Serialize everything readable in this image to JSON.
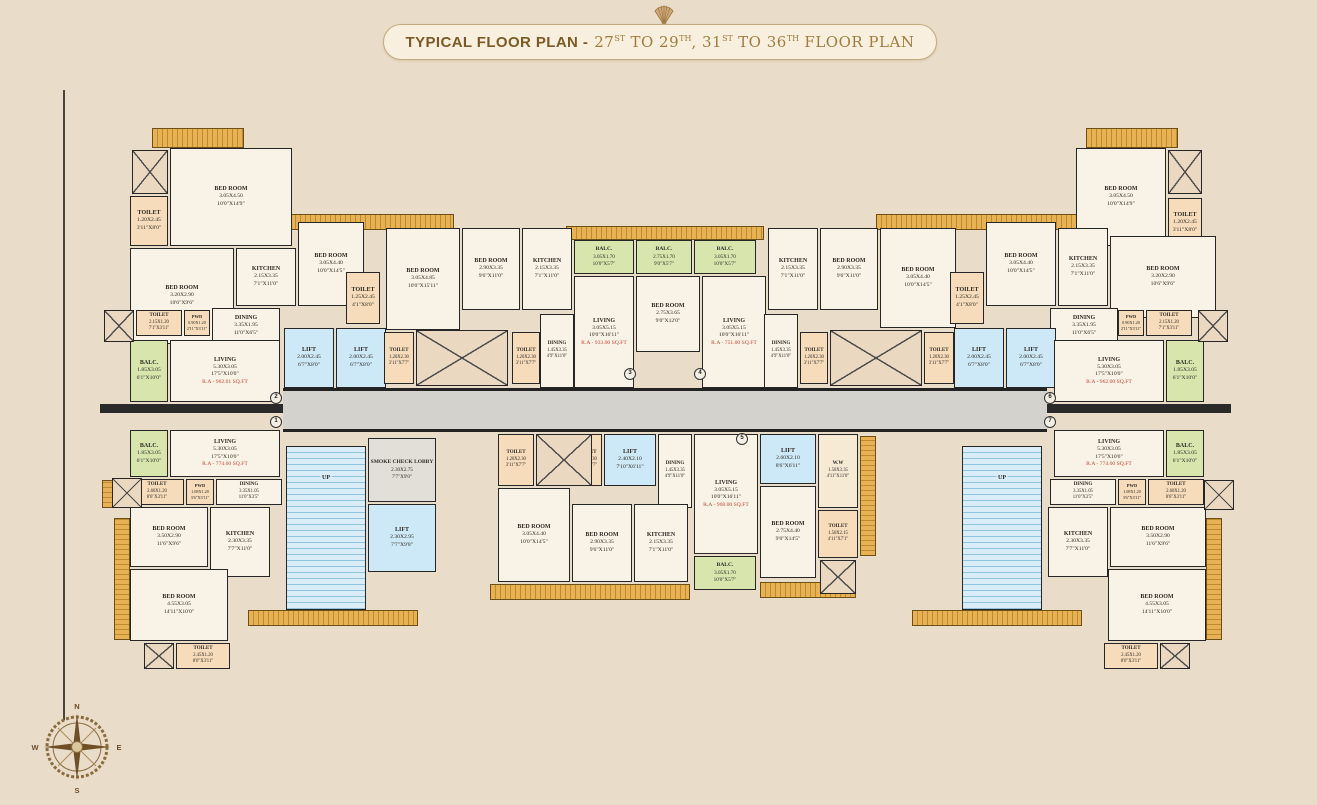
{
  "title": {
    "bold": "TYPICAL FLOOR PLAN -",
    "parts": [
      [
        "27",
        "ST"
      ],
      [
        " TO 29",
        "TH"
      ],
      [
        ", 31",
        "ST"
      ],
      [
        " TO 36",
        "TH"
      ],
      [
        " FLOOR PLAN",
        ""
      ]
    ]
  },
  "compass": {
    "n": "N",
    "e": "E",
    "s": "S",
    "w": "W"
  },
  "unit_markers": [
    "2",
    "1",
    "3",
    "4",
    "5",
    "6",
    "7"
  ],
  "colors": {
    "background": "#e9dcc8",
    "title_text": "#7c5a26",
    "title_text_light": "#a07c3e",
    "wall": "#262626",
    "room_fill": "#f9f2e6",
    "toilet_fill": "#f6dcba",
    "balcony_fill": "#d8e6ae",
    "lift_fill": "#cde8f6",
    "corridor_fill": "#d4d2cc",
    "ledge_fill": "#e8b254",
    "area_text": "#c4473a"
  },
  "rooms": [
    {
      "id": "L2",
      "kind": "toilet",
      "name": "TOILET",
      "m": "1.20X2.45",
      "ft": "3'11\"X8'0\""
    },
    {
      "id": "L3",
      "kind": "bed",
      "name": "BED ROOM",
      "m": "3.05X4.50",
      "ft": "10'0\"X14'9\""
    },
    {
      "id": "L4",
      "kind": "bed",
      "name": "BED ROOM",
      "m": "3.20X2.90",
      "ft": "10'6\"X9'6\""
    },
    {
      "id": "L5",
      "kind": "kitchen",
      "name": "KITCHEN",
      "m": "2.15X3.35",
      "ft": "7'1\"X11'0\""
    },
    {
      "id": "L6",
      "kind": "bed",
      "name": "BED ROOM",
      "m": "3.05X4.40",
      "ft": "10'0\"X14'5\""
    },
    {
      "id": "L7",
      "kind": "toilet",
      "name": "TOILET",
      "m": "1.25X2.45",
      "ft": "4'1\"X8'0\""
    },
    {
      "id": "L8",
      "kind": "dining",
      "name": "DINING",
      "m": "3.35X1.95",
      "ft": "11'0\"X6'5\""
    },
    {
      "id": "L9",
      "kind": "toilet",
      "name": "TOILET",
      "m": "2.15X1.20",
      "ft": "7'1\"X3'11\""
    },
    {
      "id": "L10",
      "kind": "toilet",
      "name": "PWD",
      "m": "0.90X1.20",
      "ft": "2'11\"X3'11\""
    },
    {
      "id": "L11",
      "kind": "balc",
      "name": "BALC.",
      "m": "1.85X3.05",
      "ft": "6'1\"X10'0\""
    },
    {
      "id": "L12",
      "kind": "living",
      "name": "LIVING",
      "m": "5.30X3.05",
      "ft": "17'5\"X10'0\"",
      "area": "R.A - 962.01 SQ.FT"
    },
    {
      "id": "L13",
      "kind": "lift",
      "name": "LIFT",
      "m": "2.00X2.45",
      "ft": "6'7\"X8'0\""
    },
    {
      "id": "L14",
      "kind": "lift",
      "name": "LIFT",
      "m": "2.00X2.45",
      "ft": "6'7\"X8'0\""
    },
    {
      "id": "L15",
      "kind": "balc",
      "name": "BALC.",
      "m": "1.85X3.05",
      "ft": "6'1\"X10'0\""
    },
    {
      "id": "L16",
      "kind": "living",
      "name": "LIVING",
      "m": "5.30X3.05",
      "ft": "17'5\"X10'0\"",
      "area": "R.A - 774.00 SQ.FT"
    },
    {
      "id": "L17",
      "kind": "toilet",
      "name": "TOILET",
      "m": "2.60X1.20",
      "ft": "8'6\"X3'11\""
    },
    {
      "id": "L18",
      "kind": "toilet",
      "name": "PWD",
      "m": "1.08X1.20",
      "ft": "3'6\"X3'11\""
    },
    {
      "id": "L19",
      "kind": "dining",
      "name": "DINING",
      "m": "3.35X1.05",
      "ft": "11'0\"X3'5\""
    },
    {
      "id": "L20",
      "kind": "bed",
      "name": "BED ROOM",
      "m": "3.50X2.90",
      "ft": "11'6\"X9'6\""
    },
    {
      "id": "L21",
      "kind": "kitchen",
      "name": "KITCHEN",
      "m": "2.30X3.35",
      "ft": "7'7\"X11'0\""
    },
    {
      "id": "L22",
      "kind": "bed",
      "name": "BED ROOM",
      "m": "4.55X3.05",
      "ft": "14'11\"X10'0\""
    },
    {
      "id": "L23",
      "kind": "toilet",
      "name": "TOILET",
      "m": "2.45X1.20",
      "ft": "8'0\"X3'11\""
    },
    {
      "id": "C1",
      "kind": "stairs",
      "name": "UP"
    },
    {
      "id": "C2",
      "kind": "lobby",
      "name": "SMOKE CHECK LOBBY",
      "m": "2.30X2.75",
      "ft": "7'7\"X9'0\""
    },
    {
      "id": "C3",
      "kind": "lift",
      "name": "LIFT",
      "m": "2.30X2.95",
      "ft": "7'7\"X9'8\""
    },
    {
      "id": "C4",
      "kind": "bed",
      "name": "BED ROOM",
      "m": "3.05X4.85",
      "ft": "10'0\"X15'11\""
    },
    {
      "id": "C5",
      "kind": "bed",
      "name": "BED ROOM",
      "m": "2.90X3.35",
      "ft": "9'6\"X11'0\""
    },
    {
      "id": "C6",
      "kind": "kitchen",
      "name": "KITCHEN",
      "m": "2.15X3.35",
      "ft": "7'1\"X11'0\""
    },
    {
      "id": "C7",
      "kind": "balc",
      "name": "BALC.",
      "m": "3.05X1.70",
      "ft": "10'0\"X5'7\""
    },
    {
      "id": "C8",
      "kind": "balc",
      "name": "BALC.",
      "m": "2.75X1.70",
      "ft": "9'0\"X5'7\""
    },
    {
      "id": "C9",
      "kind": "balc",
      "name": "BALC.",
      "m": "3.05X1.70",
      "ft": "10'0\"X5'7\""
    },
    {
      "id": "C10",
      "kind": "living",
      "name": "LIVING",
      "m": "3.05X5.15",
      "ft": "10'0\"X16'11\"",
      "area": "R.A - 933.00 SQ.FT"
    },
    {
      "id": "C11",
      "kind": "bed",
      "name": "BED ROOM",
      "m": "2.75X3.65",
      "ft": "9'0\"X12'0\""
    },
    {
      "id": "C12",
      "kind": "living",
      "name": "LIVING",
      "m": "3.05X5.15",
      "ft": "10'0\"X16'11\"",
      "area": "R.A - 751.00 SQ.FT"
    },
    {
      "id": "C13",
      "kind": "toilet",
      "name": "TOILET",
      "m": "1.20X2.30",
      "ft": "3'11\"X7'7\""
    },
    {
      "id": "C15",
      "kind": "toilet",
      "name": "TOILET",
      "m": "1.20X2.30",
      "ft": "3'11\"X7'7\""
    },
    {
      "id": "C16",
      "kind": "dining",
      "name": "DINING",
      "m": "1.45X3.35",
      "ft": "4'9\"X11'0\""
    },
    {
      "id": "C17",
      "kind": "dining",
      "name": "DINING",
      "m": "1.45X3.35",
      "ft": "4'9\"X11'0\""
    },
    {
      "id": "C18",
      "kind": "toilet",
      "name": "TOILET",
      "m": "1.20X2.30",
      "ft": "3'11\"X7'7\""
    },
    {
      "id": "C20",
      "kind": "toilet",
      "name": "TOILET",
      "m": "1.20X2.30",
      "ft": "3'11\"X7'7\""
    },
    {
      "id": "C21",
      "kind": "kitchen",
      "name": "KITCHEN",
      "m": "2.15X3.35",
      "ft": "7'1\"X11'0\""
    },
    {
      "id": "C22",
      "kind": "bed",
      "name": "BED ROOM",
      "m": "2.90X3.35",
      "ft": "9'6\"X11'0\""
    },
    {
      "id": "C23",
      "kind": "bed",
      "name": "BED ROOM",
      "m": "3.05X4.40",
      "ft": "10'0\"X14'5\""
    },
    {
      "id": "C24",
      "kind": "toilet",
      "name": "TOILET",
      "m": "1.20X2.30",
      "ft": "3'11\"X7'7\""
    },
    {
      "id": "C26",
      "kind": "toilet",
      "name": "TOILET",
      "m": "1.20X2.30",
      "ft": "3'11\"X7'7\""
    },
    {
      "id": "C27",
      "kind": "lift",
      "name": "LIFT",
      "m": "2.40X2.10",
      "ft": "7'10\"X6'11\""
    },
    {
      "id": "C28",
      "kind": "dining",
      "name": "DINING",
      "m": "1.45X3.35",
      "ft": "4'9\"X11'0\""
    },
    {
      "id": "C29",
      "kind": "living",
      "name": "LIVING",
      "m": "3.05X5.15",
      "ft": "10'0\"X16'11\"",
      "area": "R.A - 968.00 SQ.FT"
    },
    {
      "id": "C30",
      "kind": "lift",
      "name": "LIFT",
      "m": "2.60X2.10",
      "ft": "8'6\"X6'11\""
    },
    {
      "id": "C31",
      "kind": "ww",
      "name": "W.W",
      "m": "1.50X3.35",
      "ft": "4'11\"X11'0\""
    },
    {
      "id": "C32",
      "kind": "bed",
      "name": "BED ROOM",
      "m": "3.05X4.40",
      "ft": "10'0\"X14'5\""
    },
    {
      "id": "C33",
      "kind": "bed",
      "name": "BED ROOM",
      "m": "2.90X3.35",
      "ft": "9'6\"X11'0\""
    },
    {
      "id": "C34",
      "kind": "kitchen",
      "name": "KITCHEN",
      "m": "2.15X3.35",
      "ft": "7'1\"X11'0\""
    },
    {
      "id": "C35",
      "kind": "bed",
      "name": "BED ROOM",
      "m": "2.75X4.40",
      "ft": "9'0\"X14'5\""
    },
    {
      "id": "C36",
      "kind": "toilet",
      "name": "TOILET",
      "m": "1.50X2.15",
      "ft": "4'11\"X7'1\""
    },
    {
      "id": "C37",
      "kind": "balc",
      "name": "BALC.",
      "m": "3.05X1.70",
      "ft": "10'0\"X5'7\""
    },
    {
      "id": "C39",
      "kind": "stairs",
      "name": "UP"
    },
    {
      "id": "R1",
      "kind": "bed",
      "name": "BED ROOM",
      "m": "3.05X4.50",
      "ft": "10'0\"X14'9\""
    },
    {
      "id": "R3",
      "kind": "toilet",
      "name": "TOILET",
      "m": "1.20X2.45",
      "ft": "3'11\"X8'0\""
    },
    {
      "id": "R4",
      "kind": "toilet",
      "name": "TOILET",
      "m": "1.25X2.45",
      "ft": "4'1\"X8'0\""
    },
    {
      "id": "R5",
      "kind": "bed",
      "name": "BED ROOM",
      "m": "3.05X4.40",
      "ft": "10'0\"X14'5\""
    },
    {
      "id": "R6",
      "kind": "kitchen",
      "name": "KITCHEN",
      "m": "2.15X3.35",
      "ft": "7'1\"X11'0\""
    },
    {
      "id": "R7",
      "kind": "bed",
      "name": "BED ROOM",
      "m": "3.20X2.90",
      "ft": "10'6\"X9'6\""
    },
    {
      "id": "R8",
      "kind": "dining",
      "name": "DINING",
      "m": "3.35X1.95",
      "ft": "11'0\"X6'5\""
    },
    {
      "id": "R9",
      "kind": "toilet",
      "name": "PWD",
      "m": "0.90X1.20",
      "ft": "2'11\"X3'11\""
    },
    {
      "id": "R10",
      "kind": "toilet",
      "name": "TOILET",
      "m": "2.15X1.20",
      "ft": "7'1\"X3'11\""
    },
    {
      "id": "R11",
      "kind": "lift",
      "name": "LIFT",
      "m": "2.00X2.45",
      "ft": "6'7\"X8'0\""
    },
    {
      "id": "R12",
      "kind": "lift",
      "name": "LIFT",
      "m": "2.00X2.45",
      "ft": "6'7\"X8'0\""
    },
    {
      "id": "R13",
      "kind": "living",
      "name": "LIVING",
      "m": "5.30X3.05",
      "ft": "17'5\"X10'0\"",
      "area": "R.A - 962.00 SQ.FT"
    },
    {
      "id": "R14",
      "kind": "balc",
      "name": "BALC.",
      "m": "1.85X3.05",
      "ft": "6'1\"X10'0\""
    },
    {
      "id": "R15",
      "kind": "living",
      "name": "LIVING",
      "m": "5.30X3.05",
      "ft": "17'5\"X10'0\"",
      "area": "R.A - 774.00 SQ.FT"
    },
    {
      "id": "R16",
      "kind": "balc",
      "name": "BALC.",
      "m": "1.85X3.05",
      "ft": "6'1\"X10'0\""
    },
    {
      "id": "R17",
      "kind": "dining",
      "name": "DINING",
      "m": "3.35X1.05",
      "ft": "11'0\"X3'5\""
    },
    {
      "id": "R18",
      "kind": "toilet",
      "name": "PWD",
      "m": "1.08X1.20",
      "ft": "3'6\"X3'11\""
    },
    {
      "id": "R19",
      "kind": "toilet",
      "name": "TOILET",
      "m": "2.60X1.20",
      "ft": "8'6\"X3'11\""
    },
    {
      "id": "R20",
      "kind": "kitchen",
      "name": "KITCHEN",
      "m": "2.30X3.35",
      "ft": "7'7\"X11'0\""
    },
    {
      "id": "R21",
      "kind": "bed",
      "name": "BED ROOM",
      "m": "3.50X2.90",
      "ft": "11'6\"X9'6\""
    },
    {
      "id": "R22",
      "kind": "bed",
      "name": "BED ROOM",
      "m": "4.55X3.05",
      "ft": "14'11\"X10'0\""
    },
    {
      "id": "R23",
      "kind": "toilet",
      "name": "TOILET",
      "m": "2.45X1.20",
      "ft": "8'0\"X3'11\""
    }
  ]
}
